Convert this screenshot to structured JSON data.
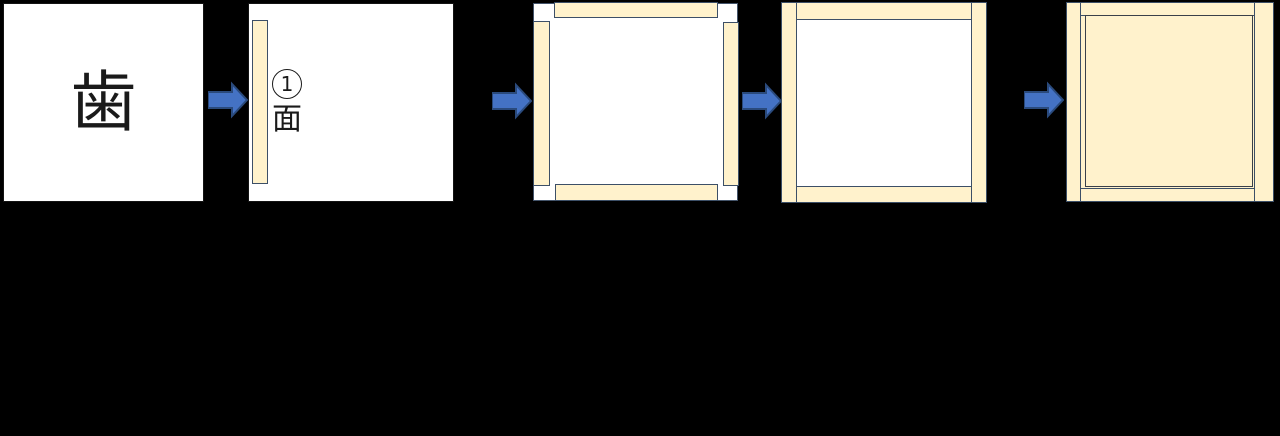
{
  "colors": {
    "background": "#000000",
    "panel_fill": "#ffffff",
    "panel_border": "#141414",
    "square_border": "#44546a",
    "plank_fill": "#fff2cc",
    "plank_border": "#3c4f67",
    "center_edge": "#808080",
    "inner_line": "#3a4049",
    "arrow_fill": "#4472c4",
    "arrow_border": "#2a4a7c",
    "text_color": "#1a1a1a"
  },
  "panels": {
    "kanji": {
      "character": "歯"
    },
    "step1": {
      "circled_number": "①",
      "number": "1",
      "text": "面"
    }
  },
  "icons": {
    "arrow": "right-block-arrow"
  }
}
